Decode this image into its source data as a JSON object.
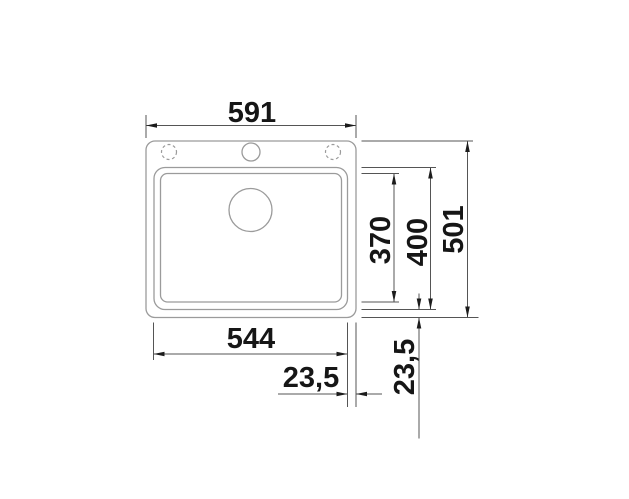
{
  "drawing": {
    "kind": "sink-top-view-dimension-drawing",
    "background": "#ffffff",
    "colors": {
      "object_line": "#9b9b9b",
      "dimension_line": "#555555",
      "text": "#161616"
    },
    "dimensions": {
      "overall_width": "591",
      "overall_depth": "501",
      "bowl_width": "544",
      "bowl_length": "400",
      "bowl_inner_length": "370",
      "offset_right": "23,5",
      "offset_bottom": "23,5"
    }
  }
}
